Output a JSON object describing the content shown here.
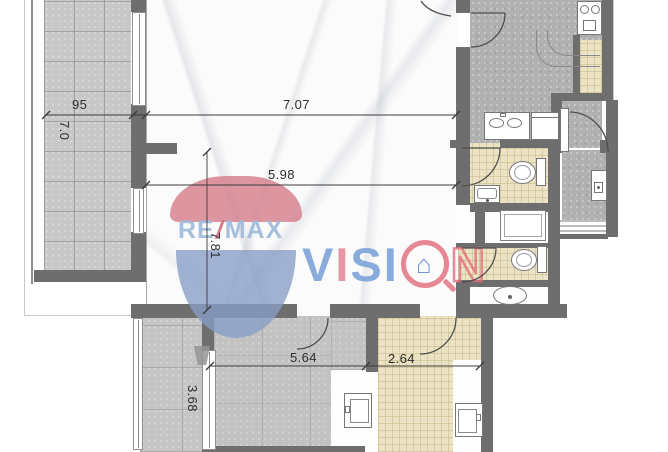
{
  "dimensions": {
    "balcony_width": "95",
    "balcony_depth": "7.0",
    "living_room_width": "7.07",
    "hall_width": "5.98",
    "hall_depth": "7.81",
    "bedroom_width": "5.64",
    "kitchenette_width": "2.64",
    "side_room_depth": "3.68"
  },
  "watermark": {
    "remax": {
      "re": "RE",
      "slash": "/",
      "max": "MAX"
    },
    "vision": {
      "letters": [
        "V",
        "I",
        "S",
        "I",
        "N"
      ],
      "house_glyph": "⌂"
    },
    "colors": {
      "vision_blue": "#6e98d4",
      "vision_pink": "#e2808f",
      "balloon_red": "#d67d8a",
      "balloon_blue": "#869cc5",
      "remax_letters": "#a0bcdb"
    }
  },
  "palette": {
    "wall": "#6e6e6e",
    "balcony_tile": "#c8c8c8",
    "dark_floor": "#b1b1b1",
    "bath_beige": "#ece3c5",
    "marble": "#fbfbfb"
  }
}
